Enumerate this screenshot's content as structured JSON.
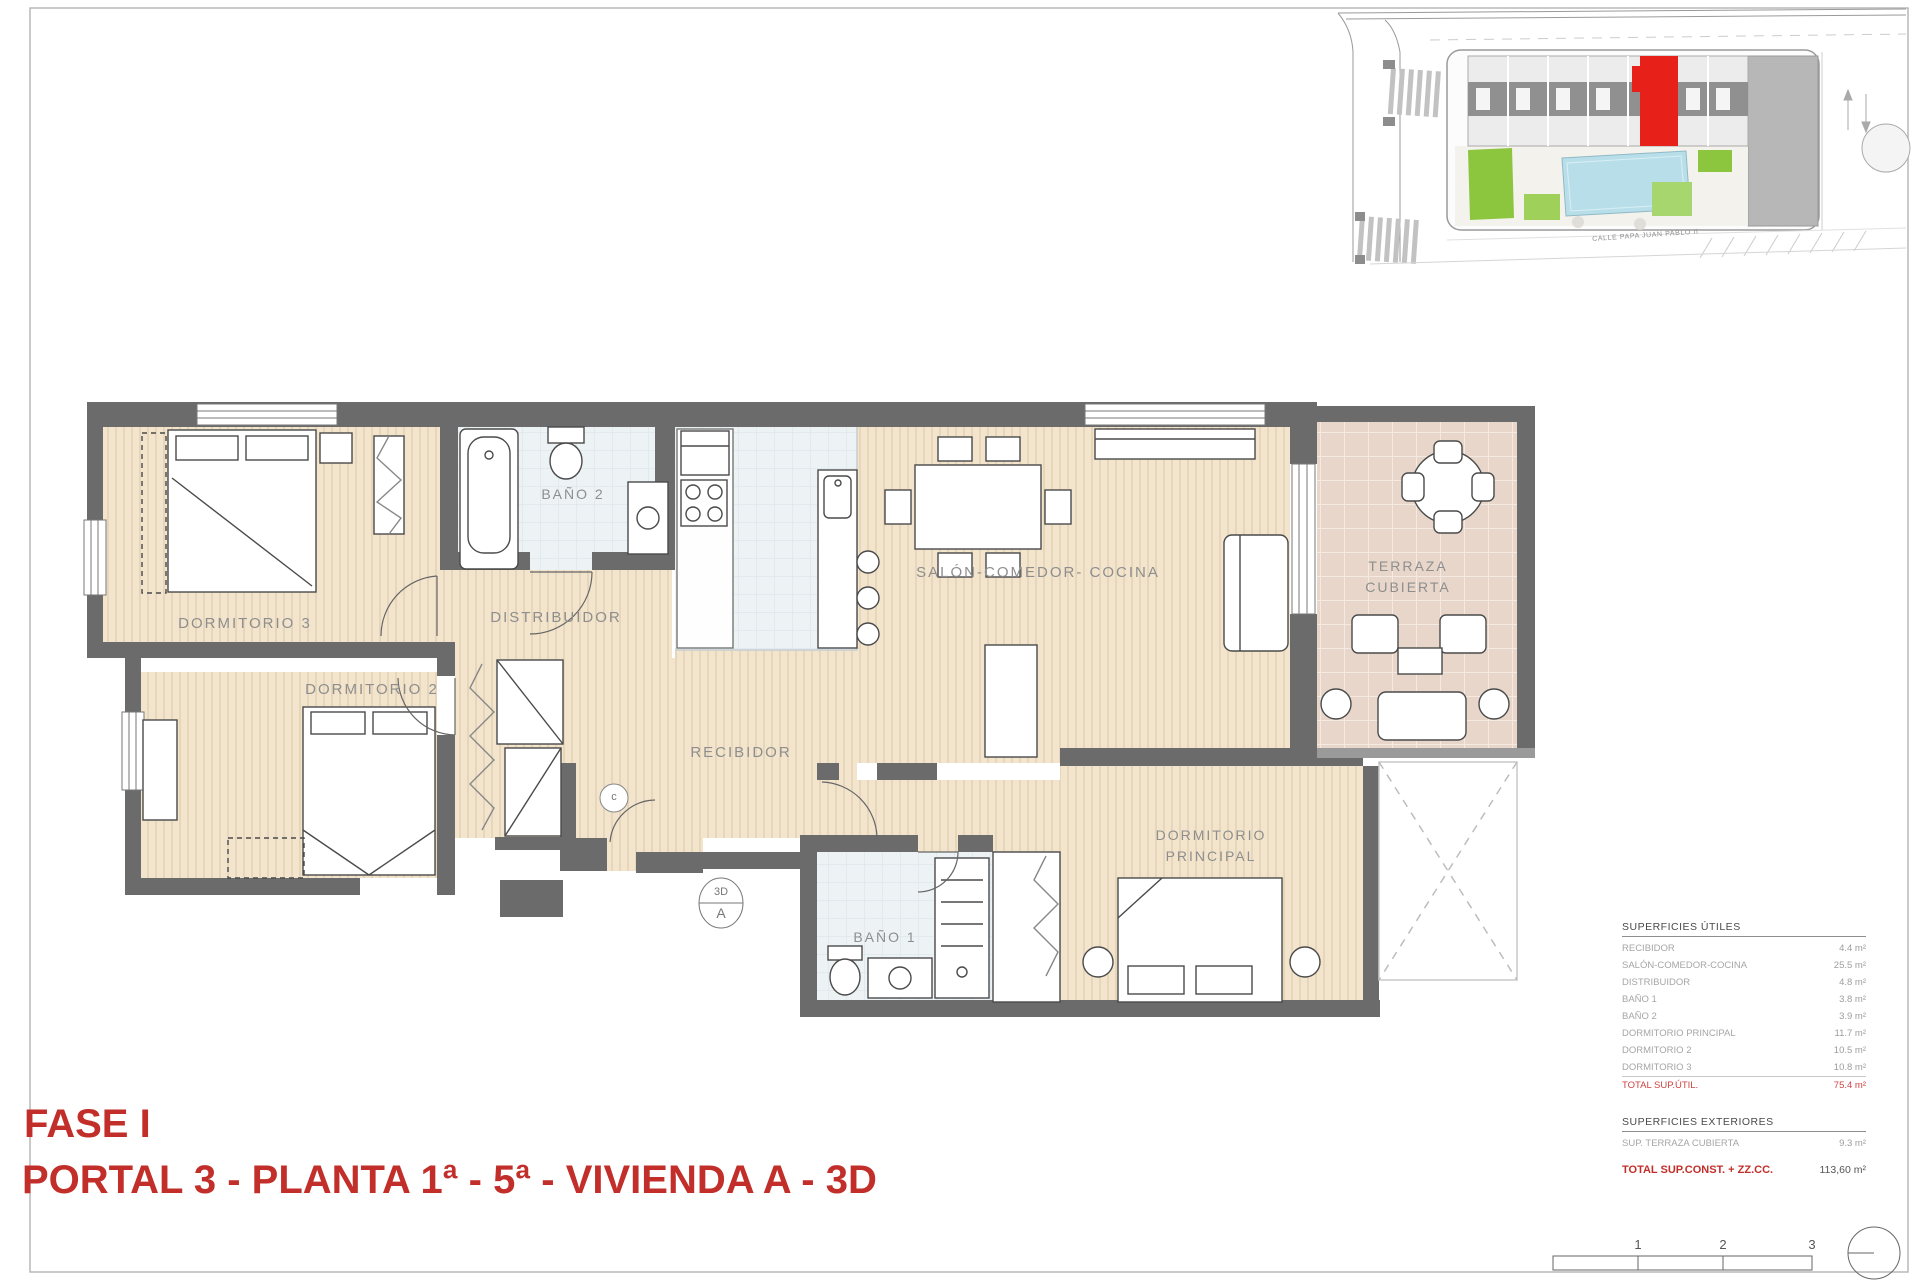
{
  "title_block": {
    "line1": "FASE I",
    "line2": "PORTAL 3 - PLANTA 1ª - 5ª - VIVIENDA A - 3D",
    "color": "#c22f2a"
  },
  "floor_plan": {
    "room_labels": {
      "dormitorio3": "DORMITORIO 3",
      "dormitorio2": "DORMITORIO 2",
      "bano2": "BAÑO 2",
      "distribuidor": "DISTRIBUIDOR",
      "recibidor": "RECIBIDOR",
      "salon": "SALÓN-COMEDOR- COCINA",
      "terraza_line1": "TERRAZA",
      "terraza_line2": "CUBIERTA",
      "bano1": "BAÑO 1",
      "dorm_principal_line1": "DORMITORIO",
      "dorm_principal_line2": "PRINCIPAL"
    },
    "markers": {
      "unit_marker_top": "3D",
      "unit_marker_bottom": "A",
      "closet_marker": "c"
    },
    "colors": {
      "wall": "#6b6b6b",
      "wood_floor": "#f3e5cd",
      "tile_floor": "#edf2f5",
      "terrace_floor": "#e7d6c9"
    }
  },
  "site_plan": {
    "street_label": "CALLE PAPA JUAN PABLO II",
    "highlight_color": "#e8201a"
  },
  "surfaces_utiles": {
    "title": "SUPERFICIES ÚTILES",
    "rows": [
      {
        "label": "RECIBIDOR",
        "value": "4.4 m²"
      },
      {
        "label": "SALÓN-COMEDOR-COCINA",
        "value": "25.5 m²"
      },
      {
        "label": "DISTRIBUIDOR",
        "value": "4.8 m²"
      },
      {
        "label": "BAÑO 1",
        "value": "3.8 m²"
      },
      {
        "label": "BAÑO 2",
        "value": "3.9 m²"
      },
      {
        "label": "DORMITORIO PRINCIPAL",
        "value": "11.7 m²"
      },
      {
        "label": "DORMITORIO 2",
        "value": "10.5 m²"
      },
      {
        "label": "DORMITORIO 3",
        "value": "10.8 m²"
      }
    ],
    "total": {
      "label": "TOTAL SUP.ÚTIL.",
      "value": "75.4 m²"
    }
  },
  "surfaces_exteriores": {
    "title": "SUPERFICIES EXTERIORES",
    "rows": [
      {
        "label": "SUP. TERRAZA CUBIERTA",
        "value": "9.3 m²"
      }
    ],
    "total": {
      "label": "TOTAL SUP.CONST. + ZZ.CC.",
      "value": "113,60 m²"
    }
  },
  "scale_bar": {
    "labels": [
      "1",
      "2",
      "3"
    ]
  }
}
